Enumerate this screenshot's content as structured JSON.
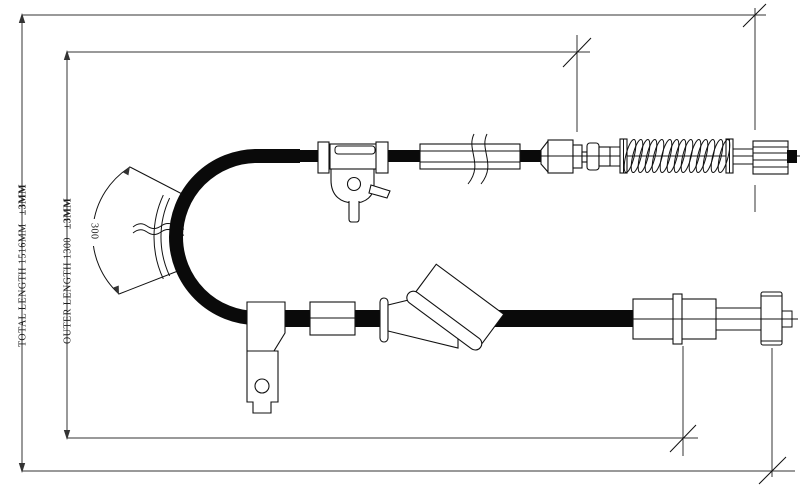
{
  "drawing": {
    "dimensions": {
      "total_length": {
        "label": "TOTAL LENGTH 1516MM",
        "tolerance": "±3MM"
      },
      "outer_length": {
        "label": "OUTER LENGTH 1300",
        "tolerance": "±3MM"
      },
      "bend_radius": {
        "label": "300"
      }
    },
    "colors": {
      "background": "#ffffff",
      "line": "#111111",
      "dimension_line": "#333333",
      "cable": "#0a0a0a"
    }
  }
}
